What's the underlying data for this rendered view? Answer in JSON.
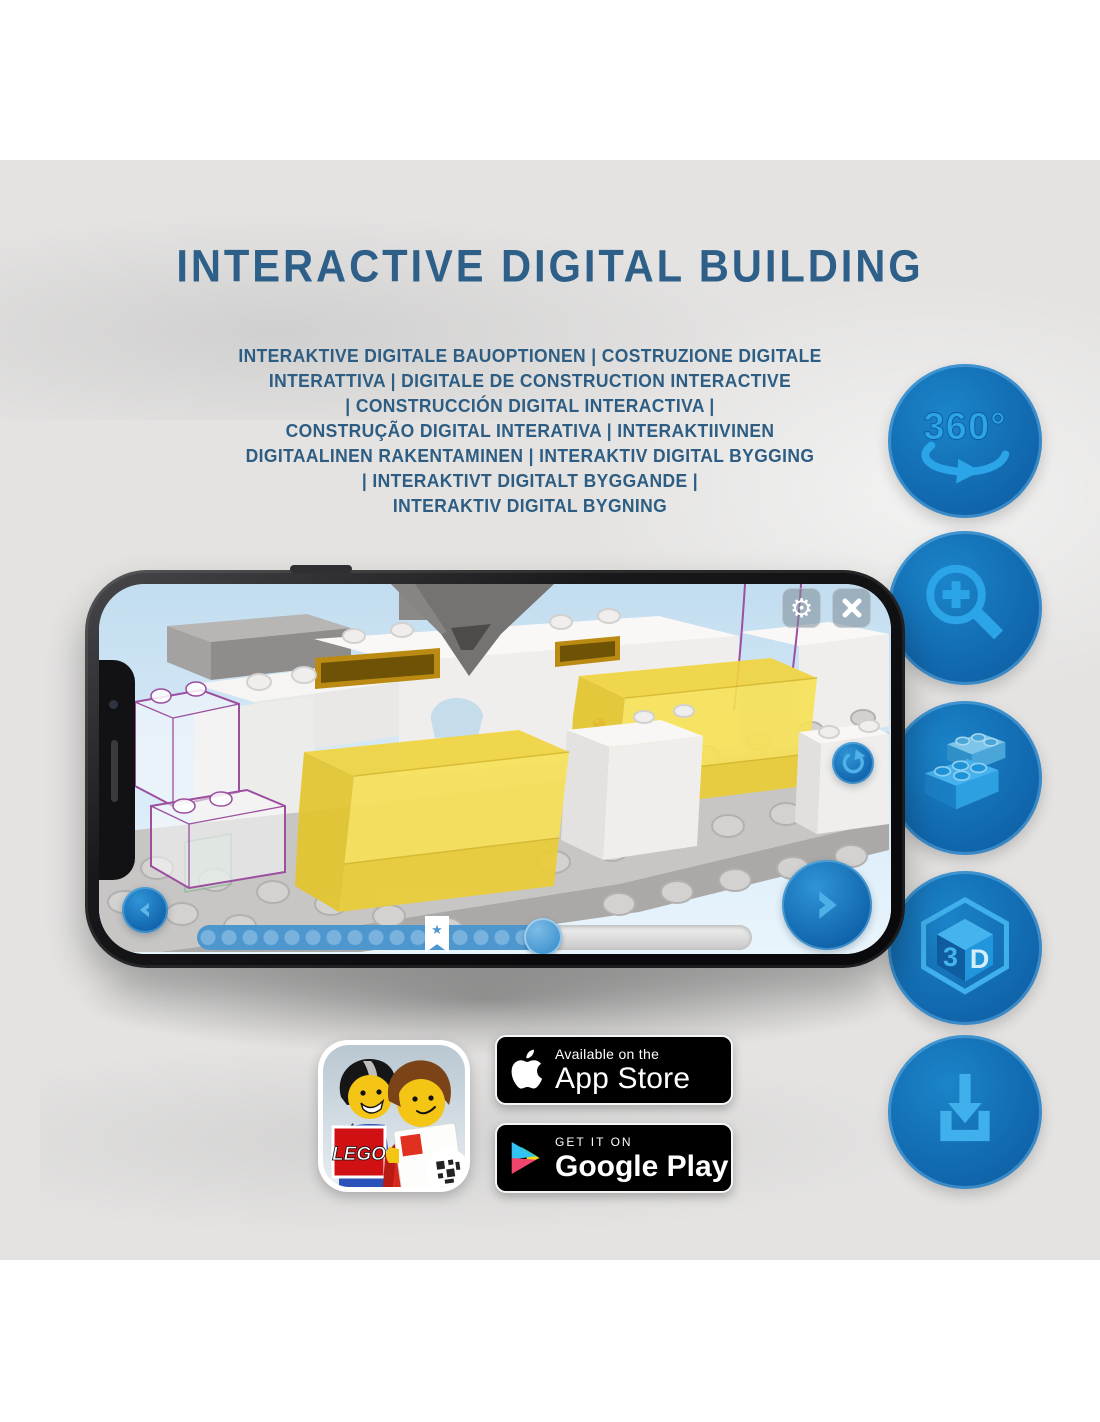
{
  "header": {
    "title": "INTERACTIVE DIGITAL BUILDING",
    "subtitle_lines": [
      "INTERAKTIVE DIGITALE BAUOPTIONEN | COSTRUZIONE DIGITALE",
      "INTERATTIVA | DIGITALE DE CONSTRUCTION INTERACTIVE",
      "| CONSTRUCCIÓN DIGITAL INTERACTIVA |",
      "CONSTRUÇÃO DIGITAL INTERATIVA | INTERAKTIIVINEN",
      "DIGITAALINEN RAKENTAMINEN | INTERAKTIV DIGITAL BYGGING",
      "| INTERAKTIVT DIGITALT BYGGANDE |",
      "INTERAKTIV DIGITAL BYGNING"
    ]
  },
  "feature_icons": {
    "names": [
      "360-rotation",
      "zoom-in",
      "brick-stack",
      "3d-view",
      "download"
    ],
    "rotation_label": "360°",
    "cube_left_label": "3",
    "cube_right_label": "D"
  },
  "screen_ui": {
    "settings_glyph": "⚙",
    "progress": {
      "filled_percent": 64,
      "marker_percent": 42,
      "marker_symbol": "★"
    }
  },
  "badges": {
    "lego_app_logo": "LEGO",
    "app_store": {
      "line1": "Available on the",
      "line2": "App Store"
    },
    "google_play": {
      "line1": "GET IT ON",
      "line2": "Google Play"
    }
  },
  "colors": {
    "title_blue": "#2e5f88",
    "band_gray": "#e4e3e2",
    "circle_blue": "#1473bd",
    "icon_light_blue": "#2ca4e8",
    "trans_yellow": "#f3d845",
    "ghost_outline_purple": "#9b4f9e",
    "ui_blue": "#4e97ce"
  }
}
